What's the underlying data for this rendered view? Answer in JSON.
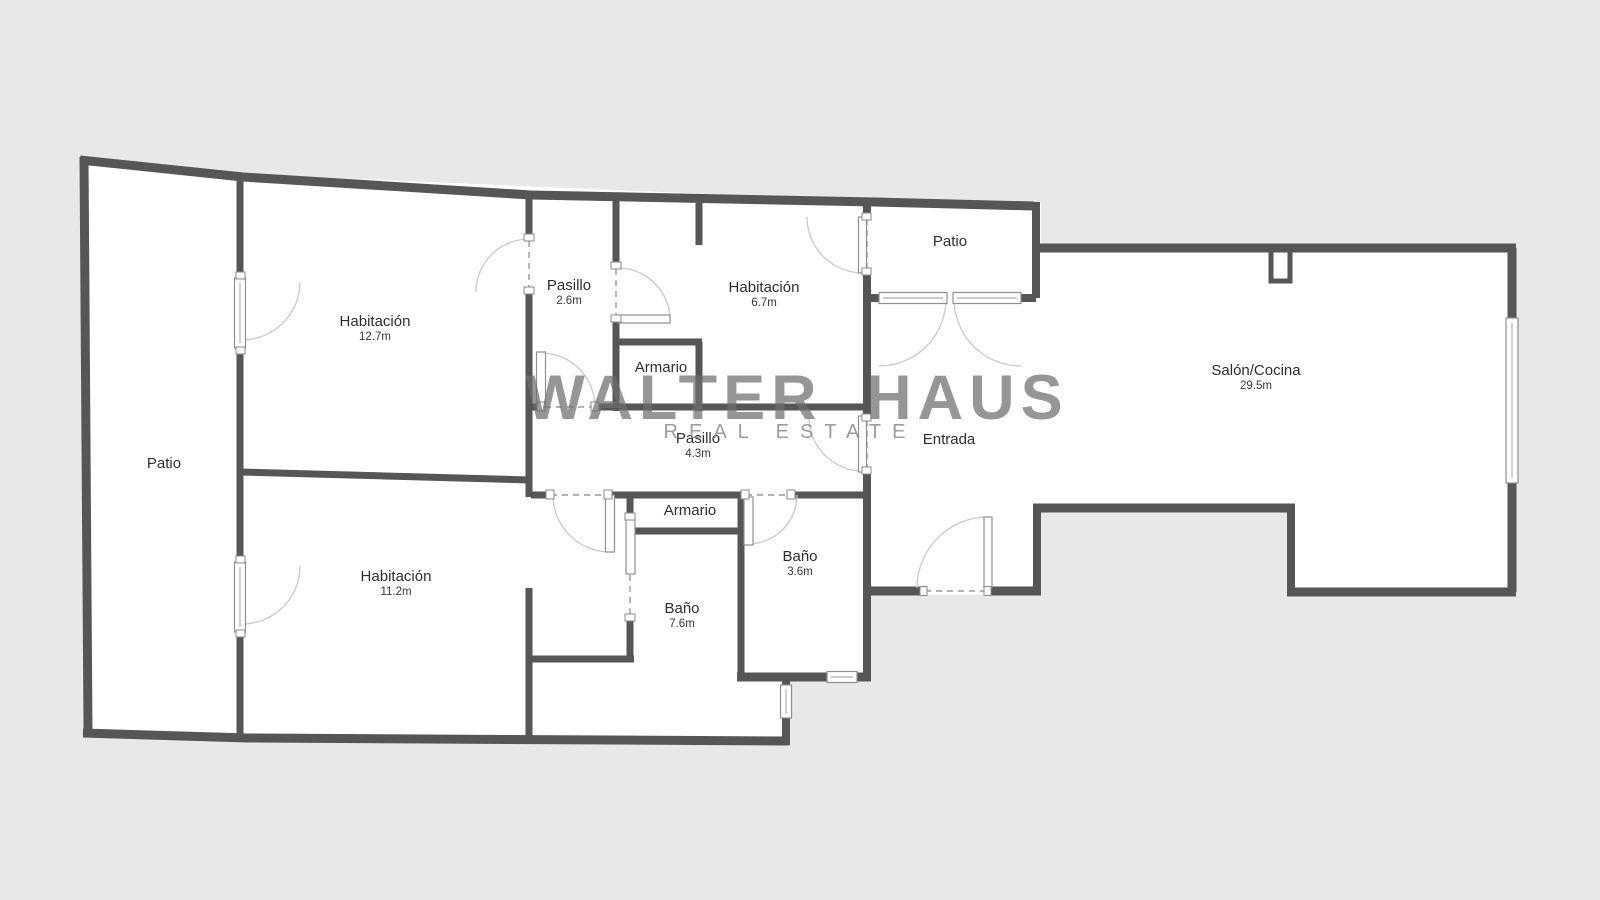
{
  "watermark": {
    "line1": "WALTER HAUS",
    "line2": "REAL ESTATE"
  },
  "rooms": {
    "patio_left": {
      "name": "Patio"
    },
    "hab_127": {
      "name": "Habitación",
      "area": "12.7m"
    },
    "pasillo_26": {
      "name": "Pasillo",
      "area": "2.6m"
    },
    "hab_67": {
      "name": "Habitación",
      "area": "6.7m"
    },
    "patio_top": {
      "name": "Patio"
    },
    "salon": {
      "name": "Salón/Cocina",
      "area": "29.5m"
    },
    "entrada": {
      "name": "Entrada"
    },
    "pasillo_43": {
      "name": "Pasillo",
      "area": "4.3m"
    },
    "armario_top": {
      "name": "Armario"
    },
    "armario_bottom": {
      "name": "Armario"
    },
    "bano_76": {
      "name": "Baño",
      "area": "7.6m"
    },
    "bano_36": {
      "name": "Baño",
      "area": "3.6m"
    },
    "hab_112": {
      "name": "Habitación",
      "area": "11.2m"
    }
  },
  "colors": {
    "wall": "#565656",
    "floor": "#ffffff",
    "background": "#e8e8e8",
    "watermark": "#6e6e6e"
  }
}
